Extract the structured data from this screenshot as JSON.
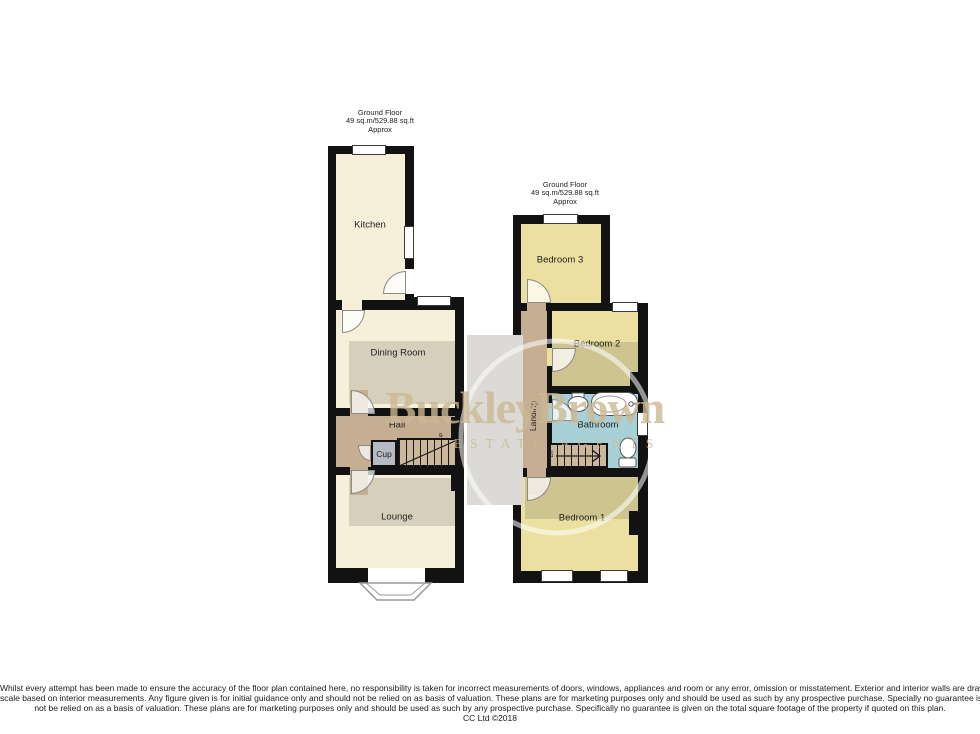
{
  "colors": {
    "wall": "#121212",
    "room-cream": "#f6efd9",
    "room-yellow": "#ebe0a0",
    "hall-tan": "#c6ae93",
    "stairs-tan": "#cbb79b",
    "cup-grey": "#b6bac3",
    "bath-blue": "#a8d0d7",
    "watermark-band": "#dbdad6",
    "watermark-text": "rgba(202,184,146,0.8)"
  },
  "ground_floor": {
    "header": {
      "line1": "Ground Floor",
      "line2": "49 sq.m/529.88 sq.ft",
      "line3": "Approx"
    },
    "rooms": {
      "kitchen": "Kitchen",
      "dining": "Dining Room",
      "hall": "Hall",
      "cup": "Cup",
      "lounge": "Lounge",
      "up": "up"
    }
  },
  "first_floor": {
    "header": {
      "line1": "Ground Floor",
      "line2": "49 sq.m/529.88 sq.ft",
      "line3": "Approx"
    },
    "rooms": {
      "bedroom3": "Bedroom 3",
      "bedroom2": "Bedroom 2",
      "bathroom": "Bathroom",
      "landing": "Landing",
      "bedroom1": "Bedroom 1",
      "dn": "Dn"
    }
  },
  "watermark": {
    "name": "BuckleyBrown",
    "tagline": "ESTATE AGENTS"
  },
  "disclaimer": {
    "line1": "Whilst every attempt has been made to ensure the accuracy of the floor plan contained here, no responsibility is taken for incorrect measurements of doors, windows, appliances and room or any error, omission or misstatement. Exterior and interior walls are drawn to",
    "line2": "scale based on interior measurements. Any figure given is for initial guidance only and should not be relied on as basis of valuation. These plans are for marketing purposes only and should be used as such by any prospective purchase. Specially no guarantee is should",
    "line3": "not be relied on as a basis of valuation. These plans are for marketing purposes only and should be used as such by any prospective purchase. Specifically no guarantee is given on the total square footage of the property if quoted on this plan.",
    "line4": "CC Ltd ©2018"
  }
}
